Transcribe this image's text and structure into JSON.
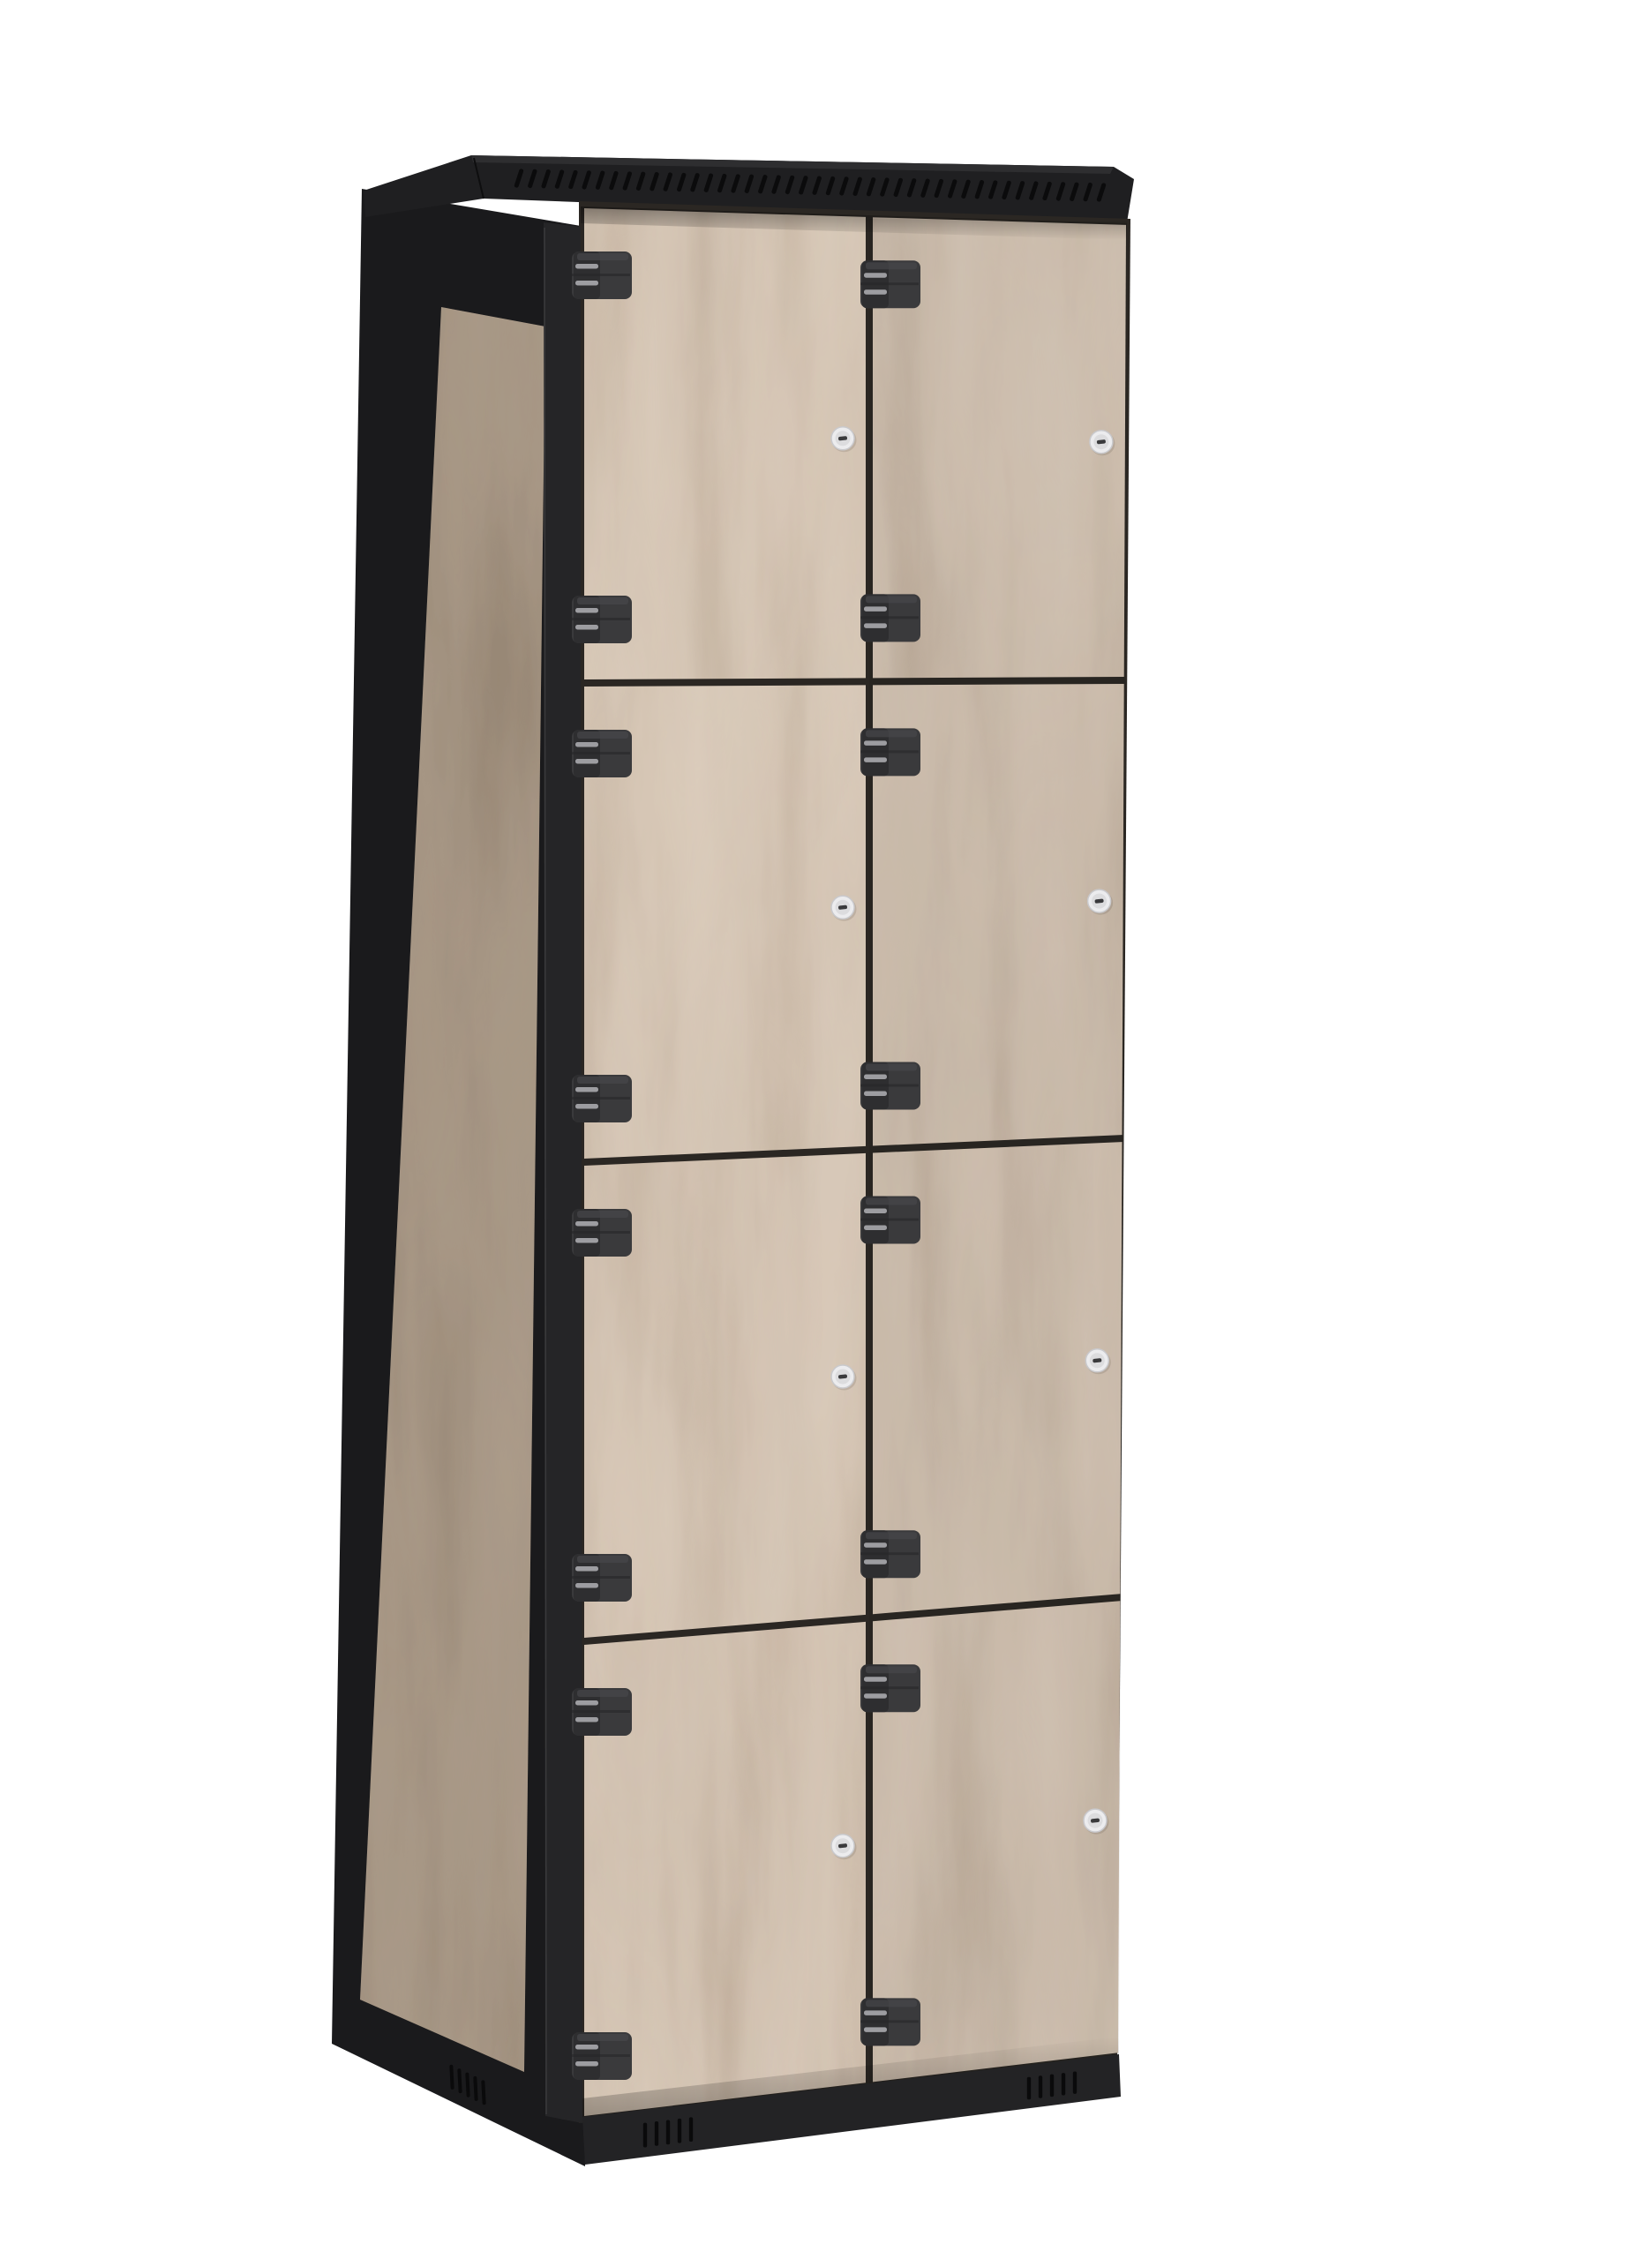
{
  "meta": {
    "type": "product-render",
    "subject": "eight-compartment locker cabinet, black steel frame with light oak wood doors",
    "view": "three-quarter view from front-left",
    "background_color": "#ffffff"
  },
  "cabinet": {
    "columns": 2,
    "rows": 4,
    "door_count": 8,
    "frame_color": "#212123",
    "cap_color": "#1f1f21",
    "cap_ridge_color": "#2e2e30",
    "side_color": "#1a1a1c",
    "post_color": "#252527",
    "base_color": "#232325",
    "gap_color": "#2b2723",
    "wood": {
      "door_base_color": "#d2c2b2",
      "door_grain_color": "#a08a75",
      "door_light_color": "#e9dccb",
      "side_base_color": "#c6b29d",
      "side_grain_color": "#8d7a64",
      "side_light_color": "#dbc9b4",
      "seeds": [
        7,
        13,
        29,
        41
      ]
    },
    "hinges": {
      "per_door": 2,
      "body_color": "#3a3a3c",
      "knuckle_color": "#2e2e30",
      "pin_color": "#9d9da1"
    },
    "locks": {
      "per_door": 1,
      "ring_color": "#ececee",
      "ring_edge_color": "#c9c9cc",
      "face_color": "#dcdcde",
      "keyhole_color": "#3a3a3c"
    },
    "top_vents": {
      "count": 44,
      "color": "#0b0b0c"
    },
    "base_vents": {
      "front_groups": 2,
      "side_groups": 1,
      "slits_per_group": 5,
      "color": "#0a0a0b"
    }
  }
}
